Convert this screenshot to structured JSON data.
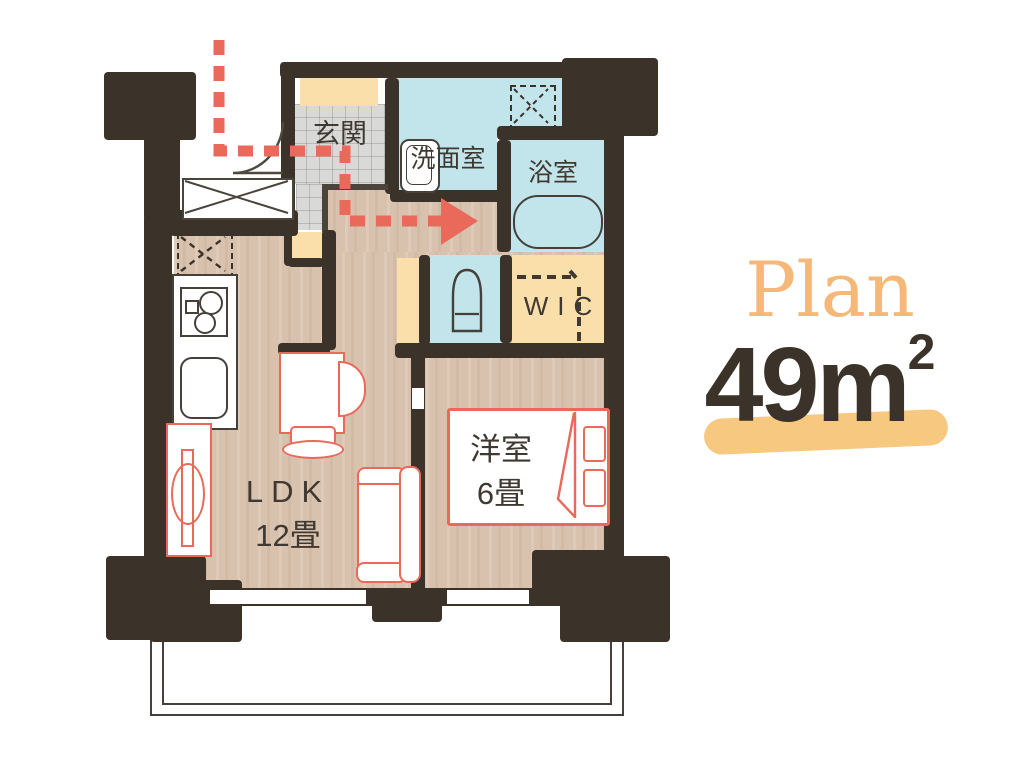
{
  "illustration": {
    "type": "apartment-floor-plan",
    "plan": {
      "label": "Plan",
      "area_number": "49",
      "area_unit": "m",
      "area_exponent": "2"
    },
    "rooms": {
      "entrance": {
        "label": "玄関"
      },
      "washroom": {
        "label": "洗面室"
      },
      "bathroom": {
        "label": "浴室"
      },
      "wic": {
        "label": "WIC"
      },
      "ldk": {
        "label": "LDK",
        "size": "12畳"
      },
      "bedroom": {
        "label": "洋室",
        "size": "6畳"
      }
    },
    "symbols": [
      "entry-route-arrow",
      "door-swing",
      "washing-machine-area",
      "refrigerator-area",
      "bathtub",
      "toilet",
      "kitchen-stove",
      "kitchen-sink",
      "bed",
      "sofa",
      "dining-table",
      "closet-rail",
      "balcony-fence"
    ],
    "colors": {
      "wall": "#3b3229",
      "wood_floor": "#d8c2ae",
      "wet_area_blue": "#c2e4eb",
      "storage_cream": "#fbdfab",
      "entrance_tile": "#d9d9d7",
      "accent_red": "#e9695b",
      "plan_orange": "#f5b878",
      "area_text": "#3b3329",
      "highlight": "#f7c87f"
    }
  }
}
